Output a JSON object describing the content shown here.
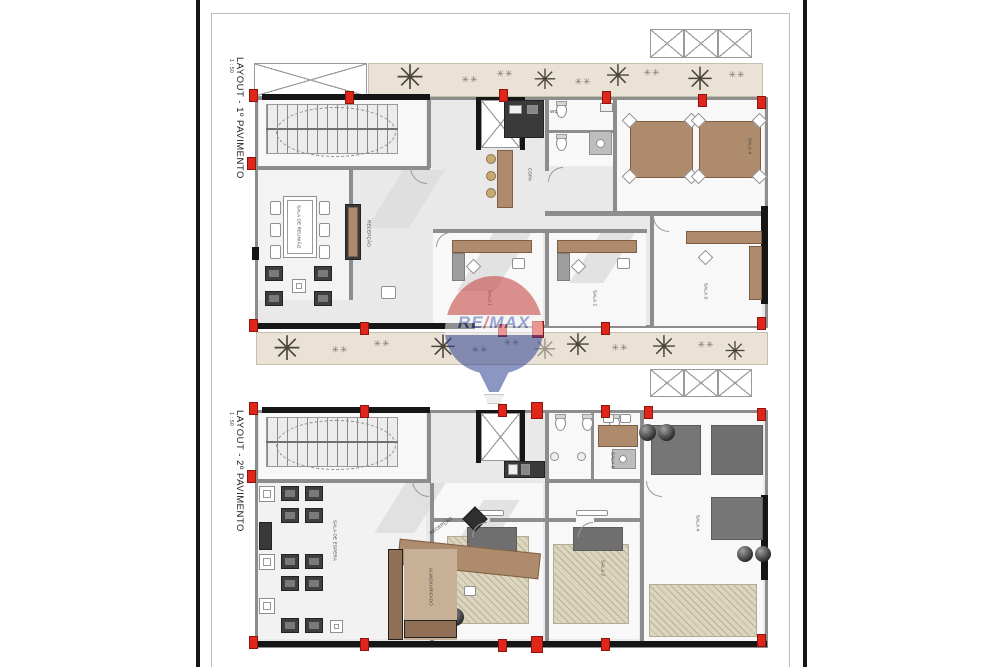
{
  "palette": {
    "page-bg": "#ffffff",
    "bar-black": "#151515",
    "sheet-border": "#bdbdbd",
    "wall-grey": "#8d8d8d",
    "wall-black": "#161616",
    "floor-grey": "#e9e9e9",
    "room-white": "#f8f8f8",
    "shade-grey": "#dcdcdc",
    "furn-brown": "#ae8b6d",
    "furn-brown-dark": "#7e5f46",
    "dark-furn": "#3f3f3f",
    "grey-block": "#767676",
    "rug-beige": "#ddd6bf",
    "landscape-beige": "#eae2d4",
    "tree-dark": "#4a453c",
    "column-red": "#e0251b",
    "stool-tan": "#c9a96f",
    "wm-red": "#c23b34",
    "wm-blue": "#2e4391",
    "wm-text": "#4a5fae"
  },
  "sheet": {
    "plan1": {
      "title": "LAYOUT - 1º PAVIMENTO",
      "scale": "1 : 50"
    },
    "plan2": {
      "title": "LAYOUT - 2º PAVIMENTO",
      "scale": "1 : 50"
    }
  },
  "watermark": {
    "re": "RE",
    "slash": "/",
    "max": "MAX"
  },
  "icons": {
    "tree": "✳",
    "shrub": "✳✳"
  },
  "plan1_rooms": {
    "meeting": "SALA DE REUNIÃO",
    "reception": "RECEPÇÃO",
    "copa": "COPA",
    "wc": "WC",
    "sala1": "SALA 1",
    "sala2": "SALA 2",
    "sala3": "SALA 3",
    "sala4": "SALA 4"
  },
  "plan2_rooms": {
    "espera": "SALA DE ESPERA",
    "reception": "RECEPÇÃO",
    "storage": "ALMOXARIFADO",
    "sala1": "SALA 1",
    "sala2": "SALA 2",
    "sala3": "SALA 3",
    "sala4": "SALA 4"
  }
}
